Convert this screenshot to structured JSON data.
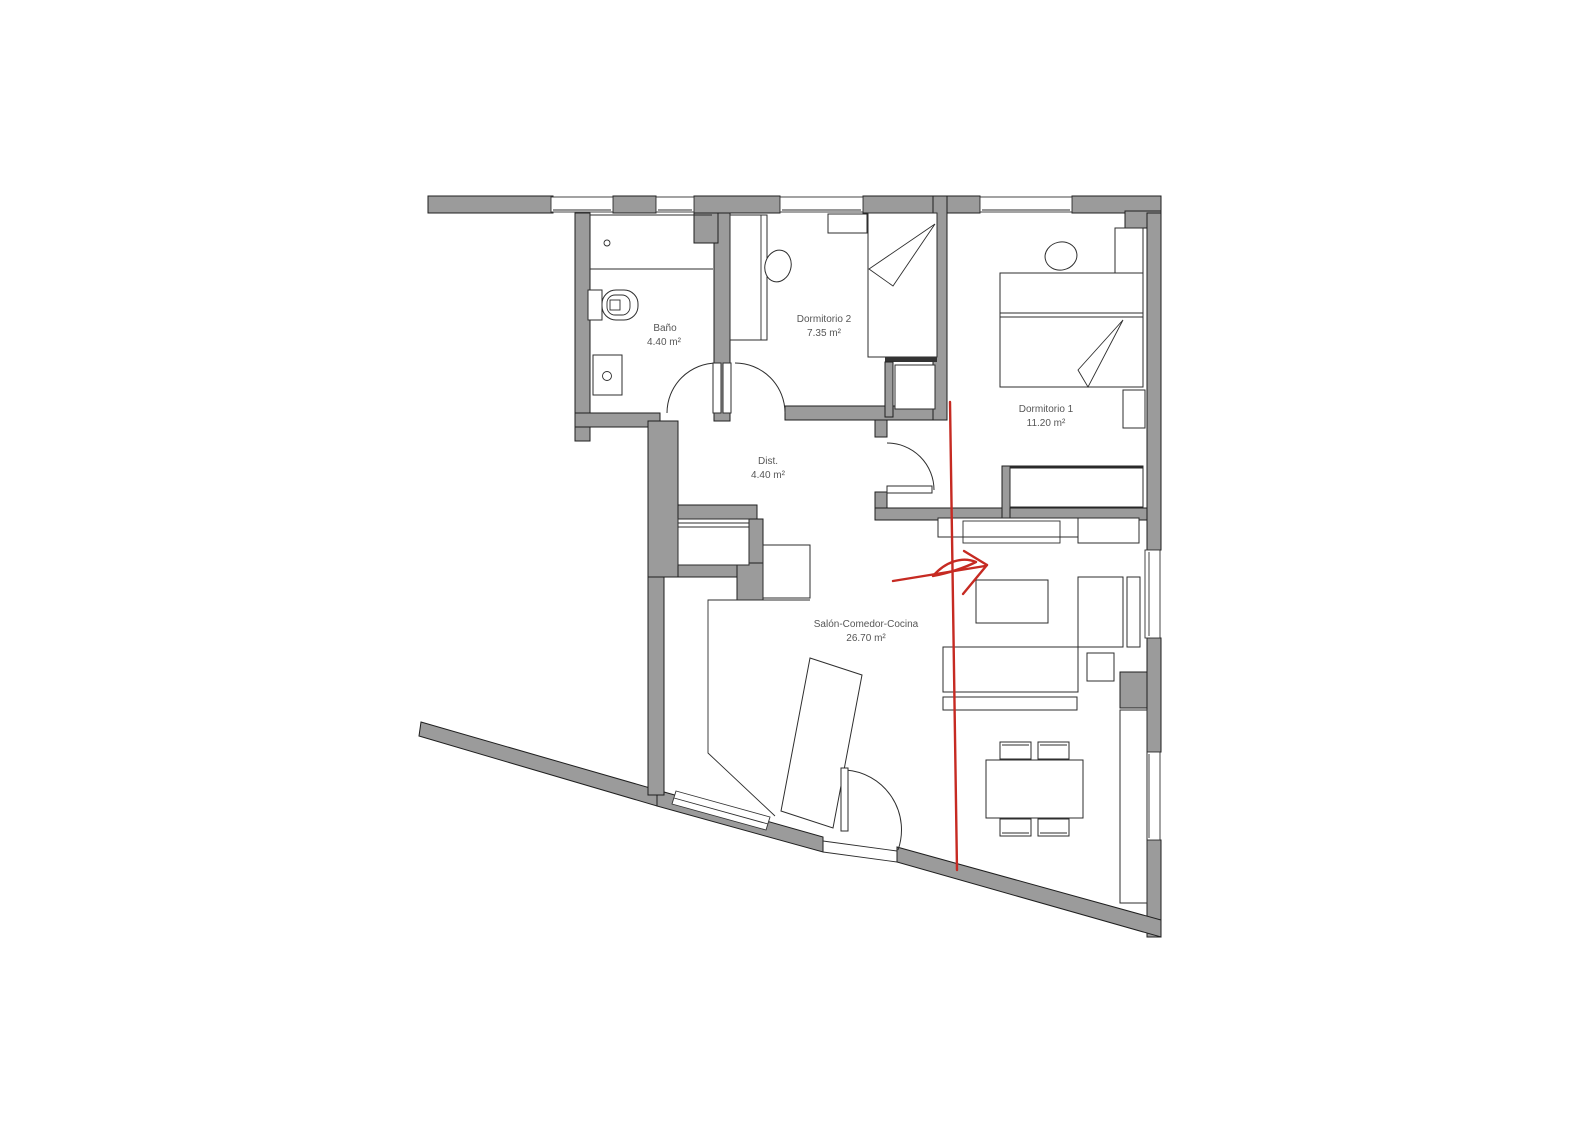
{
  "page": {
    "background": "#ffffff"
  },
  "plan": {
    "name": "apartment-floor-plan",
    "colors": {
      "page_background": "#ffffff",
      "wall_fill": "#9b9b9b",
      "wall_outline": "#1f1f1f",
      "furniture_line": "#2e2e2e",
      "label_text": "#565656",
      "annotation_red": "#c62a22"
    },
    "rooms": [
      {
        "name": "Baño",
        "area": "4.40 m²"
      },
      {
        "name": "Dormitorio 2",
        "area": "7.35 m²"
      },
      {
        "name": "Dormitorio 1",
        "area": "11.20 m²"
      },
      {
        "name": "Dist.",
        "area": "4.40 m²"
      },
      {
        "name": "Salón-Comedor-Cocina",
        "area": "26.70 m²"
      }
    ],
    "annotation": {
      "description": "hand-drawn red vertical stroke crossing the plan and a red arrow pointing right",
      "color": "#c62a22"
    }
  }
}
